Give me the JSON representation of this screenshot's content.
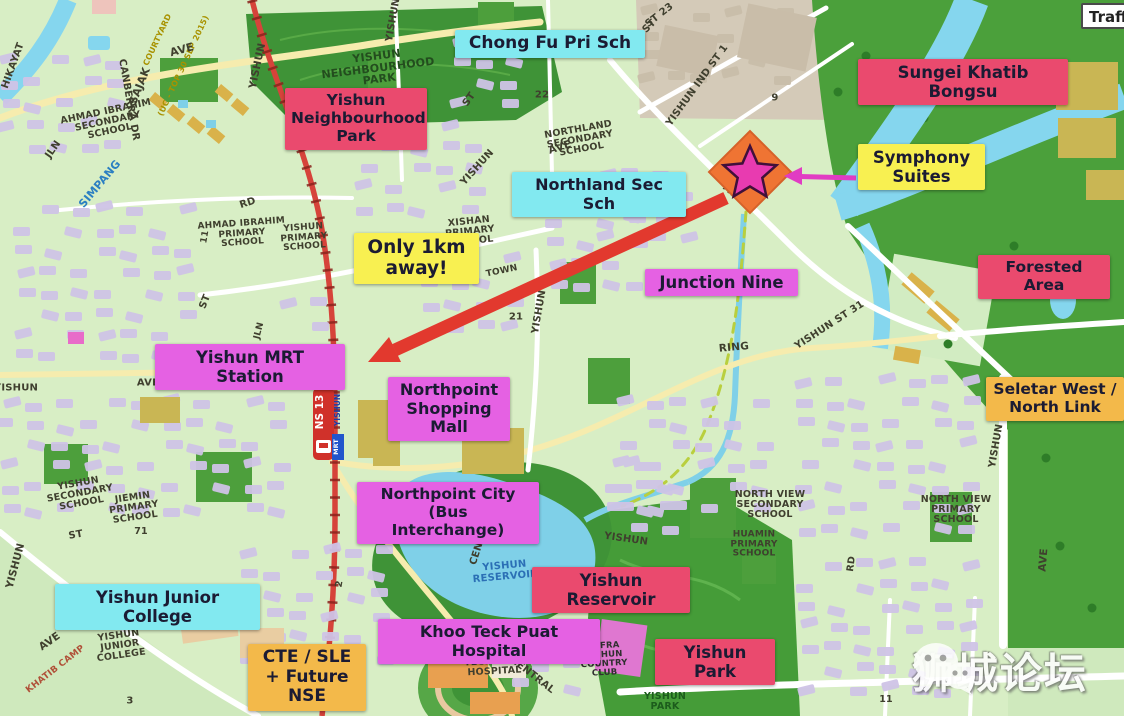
{
  "traffic_button": {
    "label": "Traffic"
  },
  "watermark": {
    "text": "狮城论坛",
    "icon": "wechat-icon"
  },
  "mrt_badge": {
    "line_code": "NS 13",
    "mrt": "MRT",
    "station": "YISHUN"
  },
  "colors": {
    "crimson": "#ea4a6e",
    "magenta": "#e561e3",
    "cyan": "#82e9f0",
    "yellow": "#f8f051",
    "amber": "#f3b94a",
    "arrow_red": "#e2392e",
    "arrow_magenta": "#e13cc3",
    "star_pink": "#e83bb0",
    "site_orange": "#ef7433",
    "forest_green": "#4ba03b",
    "water_blue": "#85d6ee"
  },
  "callouts": [
    {
      "id": "chong-fu-pri-sch",
      "text": "Chong Fu Pri Sch",
      "color": "cyan",
      "x": 455,
      "y": 30,
      "w": 178,
      "fs": 17
    },
    {
      "id": "sungei-khatib-bongsu",
      "text": "Sungei Khatib Bongsu",
      "color": "crimson",
      "x": 858,
      "y": 59,
      "w": 198,
      "fs": 16.5
    },
    {
      "id": "yishun-neighbourhood-park",
      "text": "Yishun\nNeighbourhood\nPark",
      "color": "crimson",
      "x": 285,
      "y": 88,
      "w": 130,
      "fs": 15.5
    },
    {
      "id": "northland-sec-sch",
      "text": "Northland Sec Sch",
      "color": "cyan",
      "x": 512,
      "y": 172,
      "w": 162,
      "fs": 16
    },
    {
      "id": "symphony-suites",
      "text": "Symphony\nSuites",
      "color": "yellow",
      "x": 858,
      "y": 144,
      "w": 115,
      "fs": 16.5
    },
    {
      "id": "forested-area",
      "text": "Forested Area",
      "color": "crimson",
      "x": 978,
      "y": 255,
      "w": 120,
      "fs": 15.5
    },
    {
      "id": "only-1km-away",
      "text": "Only 1km\naway!",
      "color": "yellow",
      "x": 354,
      "y": 233,
      "w": 113,
      "fs": 18.5
    },
    {
      "id": "junction-nine",
      "text": "Junction Nine",
      "color": "magenta",
      "x": 645,
      "y": 269,
      "w": 141,
      "fs": 16.5
    },
    {
      "id": "yishun-mrt-station",
      "text": "Yishun MRT Station",
      "color": "magenta",
      "x": 155,
      "y": 344,
      "w": 178,
      "fs": 16.5
    },
    {
      "id": "northpoint-shopping-mall",
      "text": "Northpoint\nShopping\nMall",
      "color": "magenta",
      "x": 388,
      "y": 377,
      "w": 110,
      "fs": 16
    },
    {
      "id": "seletar-west-north-link",
      "text": "Seletar West /\nNorth Link",
      "color": "amber",
      "x": 986,
      "y": 377,
      "w": 126,
      "fs": 15.5
    },
    {
      "id": "northpoint-city-bus",
      "text": "Northpoint City (Bus\nInterchange)",
      "color": "magenta",
      "x": 357,
      "y": 482,
      "w": 170,
      "fs": 15.5
    },
    {
      "id": "yishun-junior-college",
      "text": "Yishun Junior College",
      "color": "cyan",
      "x": 55,
      "y": 584,
      "w": 193,
      "fs": 16.5
    },
    {
      "id": "yishun-reservoir",
      "text": "Yishun Reservoir",
      "color": "crimson",
      "x": 532,
      "y": 567,
      "w": 146,
      "fs": 16.5
    },
    {
      "id": "khoo-teck-puat-hospital",
      "text": "Khoo Teck Puat Hospital",
      "color": "magenta",
      "x": 378,
      "y": 619,
      "w": 210,
      "fs": 16
    },
    {
      "id": "yishun-park",
      "text": "Yishun Park",
      "color": "crimson",
      "x": 655,
      "y": 639,
      "w": 108,
      "fs": 16.5
    },
    {
      "id": "cte-sle-future-nse",
      "text": "CTE / SLE\n+ Future\nNSE",
      "color": "amber",
      "x": 248,
      "y": 644,
      "w": 106,
      "fs": 17
    }
  ],
  "map_labels": [
    {
      "t": "HIKAYAT",
      "x": 14,
      "y": 66,
      "r": -70,
      "s": 10
    },
    {
      "t": "JLN",
      "x": 54,
      "y": 150,
      "r": -55,
      "s": 10
    },
    {
      "t": "SAJAK",
      "x": 140,
      "y": 86,
      "r": -68,
      "s": 11
    },
    {
      "t": "SIMPANG",
      "x": 100,
      "y": 184,
      "r": -50,
      "s": 11,
      "c": "#2b7fc2"
    },
    {
      "t": "CANBERRA DR",
      "x": 128,
      "y": 100,
      "r": 80,
      "s": 10
    },
    {
      "t": "COURTYARD",
      "x": 158,
      "y": 40,
      "r": -65,
      "s": 8,
      "c": "#a89200"
    },
    {
      "t": "(UC - TOP 30 SEP 2015)",
      "x": 184,
      "y": 66,
      "r": -65,
      "s": 8,
      "c": "#a89200"
    },
    {
      "t": "AVE",
      "x": 182,
      "y": 50,
      "r": -15,
      "s": 11
    },
    {
      "t": "AHMAD IBRAHIM\nSECONDARY\nSCHOOL",
      "x": 108,
      "y": 122,
      "r": -12,
      "s": 9.5
    },
    {
      "t": "YISHUN",
      "x": 258,
      "y": 66,
      "r": -78,
      "s": 10.5
    },
    {
      "t": "YISHUN\nNEIGHBOURHOOD\nPARK",
      "x": 378,
      "y": 68,
      "r": -7,
      "s": 11,
      "c": "#234d1e"
    },
    {
      "t": "ST 23",
      "x": 660,
      "y": 16,
      "r": -38,
      "s": 10
    },
    {
      "t": "YISHUN IND ST 1",
      "x": 698,
      "y": 86,
      "r": -54,
      "s": 10
    },
    {
      "t": "9",
      "x": 775,
      "y": 99,
      "r": 0,
      "s": 10
    },
    {
      "t": "AVE",
      "x": 733,
      "y": 194,
      "r": 40,
      "s": 10.5
    },
    {
      "t": "NORTHLAND\nSECONDARY\nSCHOOL",
      "x": 580,
      "y": 140,
      "r": -10,
      "s": 9.5
    },
    {
      "t": "ST",
      "x": 470,
      "y": 100,
      "r": -55,
      "s": 10
    },
    {
      "t": "22",
      "x": 542,
      "y": 96,
      "r": 0,
      "s": 10
    },
    {
      "t": "YISHUN",
      "x": 394,
      "y": 20,
      "r": -80,
      "s": 10
    },
    {
      "t": "ST",
      "x": 650,
      "y": 27,
      "r": -45,
      "s": 10
    },
    {
      "t": "AVE",
      "x": 560,
      "y": 148,
      "r": -18,
      "s": 10.5
    },
    {
      "t": "XISHAN\nPRIMARY\nSCHOOL",
      "x": 470,
      "y": 232,
      "r": -6,
      "s": 9.5
    },
    {
      "t": "TOWN",
      "x": 502,
      "y": 272,
      "r": -12,
      "s": 9
    },
    {
      "t": "RD",
      "x": 248,
      "y": 204,
      "r": -18,
      "s": 10
    },
    {
      "t": "AHMAD IBRAHIM\nPRIMARY\nSCHOOL",
      "x": 242,
      "y": 234,
      "r": -4,
      "s": 9
    },
    {
      "t": "YISHUN\nPRIMARY\nSCHOOL",
      "x": 304,
      "y": 238,
      "r": -4,
      "s": 9
    },
    {
      "t": "11",
      "x": 206,
      "y": 237,
      "r": -80,
      "s": 9
    },
    {
      "t": "ST",
      "x": 206,
      "y": 302,
      "r": -68,
      "s": 10
    },
    {
      "t": "YISHUN",
      "x": 478,
      "y": 168,
      "r": -48,
      "s": 10
    },
    {
      "t": "YISHUN",
      "x": 540,
      "y": 312,
      "r": -80,
      "s": 10
    },
    {
      "t": "RING",
      "x": 734,
      "y": 348,
      "r": -5,
      "s": 10.5
    },
    {
      "t": "YISHUN ST 31",
      "x": 830,
      "y": 326,
      "r": -33,
      "s": 10
    },
    {
      "t": "21",
      "x": 516,
      "y": 318,
      "r": 0,
      "s": 10
    },
    {
      "t": "5",
      "x": 270,
      "y": 382,
      "r": 0,
      "s": 10
    },
    {
      "t": "AVE",
      "x": 148,
      "y": 384,
      "r": 0,
      "s": 10
    },
    {
      "t": "JLN",
      "x": 260,
      "y": 331,
      "r": -75,
      "s": 9
    },
    {
      "t": "YISHUN",
      "x": 16,
      "y": 389,
      "r": 0,
      "s": 10
    },
    {
      "t": "YISHUN\nSECONDARY\nSCHOOL",
      "x": 80,
      "y": 494,
      "r": -10,
      "s": 9.5
    },
    {
      "t": "JIEMIN\nPRIMARY\nSCHOOL",
      "x": 134,
      "y": 508,
      "r": -8,
      "s": 9.5
    },
    {
      "t": "71",
      "x": 141,
      "y": 532,
      "r": 0,
      "s": 9.5
    },
    {
      "t": "ST",
      "x": 76,
      "y": 536,
      "r": -10,
      "s": 10
    },
    {
      "t": "YISHUN",
      "x": 16,
      "y": 566,
      "r": -75,
      "s": 10.5
    },
    {
      "t": "AVE",
      "x": 50,
      "y": 642,
      "r": -35,
      "s": 10.5
    },
    {
      "t": "KHATIB CAMP",
      "x": 56,
      "y": 670,
      "r": -38,
      "s": 9,
      "c": "#b05038"
    },
    {
      "t": "YISHUN\nJUNIOR\nCOLLEGE",
      "x": 120,
      "y": 646,
      "r": -8,
      "s": 9.5
    },
    {
      "t": "3",
      "x": 130,
      "y": 702,
      "r": 0,
      "s": 10
    },
    {
      "t": "2",
      "x": 340,
      "y": 584,
      "r": -80,
      "s": 9.5
    },
    {
      "t": "CENTRAL",
      "x": 482,
      "y": 540,
      "r": -72,
      "s": 10
    },
    {
      "t": "CENTRAL",
      "x": 532,
      "y": 676,
      "r": 38,
      "s": 10
    },
    {
      "t": "NORTH VIEW\nSECONDARY\nSCHOOL",
      "x": 770,
      "y": 505,
      "r": 0,
      "s": 9.5
    },
    {
      "t": "HUAMIN\nPRIMARY\nSCHOOL",
      "x": 754,
      "y": 545,
      "r": 0,
      "s": 9
    },
    {
      "t": "NORTH VIEW\nPRIMARY\nSCHOOL",
      "x": 956,
      "y": 510,
      "r": 0,
      "s": 9.5
    },
    {
      "t": "RD",
      "x": 852,
      "y": 564,
      "r": -82,
      "s": 9.5
    },
    {
      "t": "YISHUN",
      "x": 626,
      "y": 540,
      "r": 8,
      "s": 10
    },
    {
      "t": "YISHUN\nRESERVOIR",
      "x": 505,
      "y": 572,
      "r": -5,
      "s": 10,
      "c": "#2b6fb5"
    },
    {
      "t": "KHOO\nTECK PUAT\nHOSPITAL",
      "x": 494,
      "y": 662,
      "r": -3,
      "s": 9.5
    },
    {
      "t": "SAFRA\nYISHUN\nCOUNTRY\nCLUB",
      "x": 604,
      "y": 660,
      "r": -3,
      "s": 8.5,
      "c": "#2f2f2f"
    },
    {
      "t": "YISHUN\nPARK",
      "x": 665,
      "y": 702,
      "r": 0,
      "s": 9.5,
      "c": "#1c5c1c"
    },
    {
      "t": "11",
      "x": 886,
      "y": 700,
      "r": 0,
      "s": 9.5
    },
    {
      "t": "YISHUN",
      "x": 997,
      "y": 446,
      "r": -80,
      "s": 10
    },
    {
      "t": "AVE",
      "x": 1044,
      "y": 560,
      "r": -85,
      "s": 10.5
    }
  ]
}
